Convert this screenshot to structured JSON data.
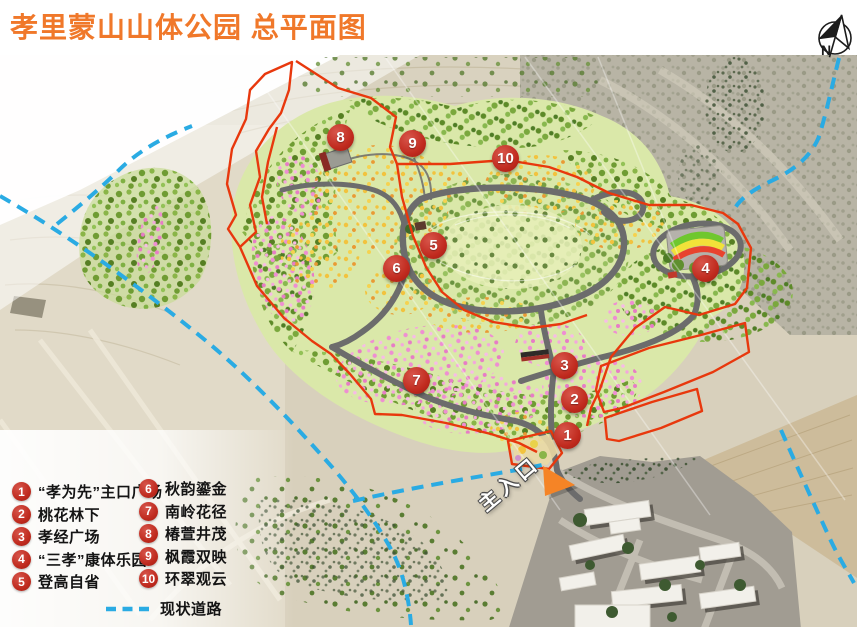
{
  "header": {
    "title": "孝里蒙山山体公园 总平面图"
  },
  "compass": {
    "label": "N"
  },
  "map": {
    "entrance_label": "主入口"
  },
  "markers": [
    "1",
    "2",
    "3",
    "4",
    "5",
    "6",
    "7",
    "8",
    "9",
    "10"
  ],
  "legend": {
    "items": [
      {
        "num": "1",
        "label": "“孝为先”主口广场"
      },
      {
        "num": "2",
        "label": "桃花林下"
      },
      {
        "num": "3",
        "label": "孝经广场"
      },
      {
        "num": "4",
        "label": "“三孝”康体乐园"
      },
      {
        "num": "5",
        "label": "登高自省"
      },
      {
        "num": "6",
        "label": "秋韵鎏金"
      },
      {
        "num": "7",
        "label": "南岭花径"
      },
      {
        "num": "8",
        "label": "椿萱井茂"
      },
      {
        "num": "9",
        "label": "枫霞双映"
      },
      {
        "num": "10",
        "label": "环翠观云"
      }
    ],
    "existing_road_label": "现状道路"
  },
  "colors": {
    "title_orange": "#F0782A",
    "marker_red": "#C02A1E",
    "boundary_red": "#E8380D",
    "existing_road_cyan": "#2AABE3",
    "road_gray": "#6C6C6C",
    "entrance_arrow_orange": "#F58426"
  }
}
